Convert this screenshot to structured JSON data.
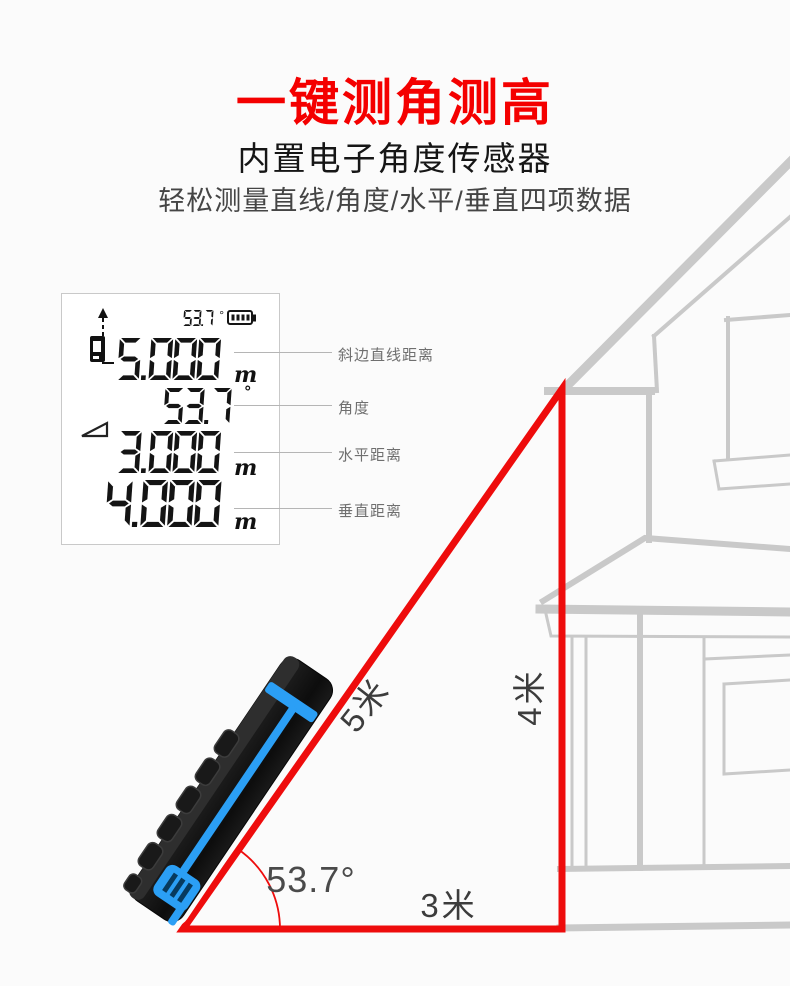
{
  "header": {
    "title": "一键测角测高",
    "subtitle": "内置电子角度传感器",
    "description": "轻松测量直线/角度/水平/垂直四项数据"
  },
  "lcd": {
    "status": {
      "angle_value": "53.7",
      "angle_unit": "°",
      "battery_icon": "battery-full-icon"
    },
    "icons": {
      "reference_icon": "device-rear-reference-icon",
      "slope_icon": "angle-slope-icon"
    },
    "rows": [
      {
        "value": "5.000",
        "unit": "m",
        "label": "斜边直线距离"
      },
      {
        "value": "53.7",
        "unit": "°",
        "label": "角度"
      },
      {
        "value": "3.000",
        "unit": "m",
        "label": "水平距离"
      },
      {
        "value": "4.000",
        "unit": "m",
        "label": "垂直距离"
      }
    ]
  },
  "diagram": {
    "hypotenuse_label": "5米",
    "vertical_label": "4米",
    "horizontal_label": "3米",
    "angle_label": "53.7°"
  },
  "colors": {
    "accent_red": "#f40000",
    "triangle_red": "#ee0c0c",
    "device_blue": "#2b9ff5",
    "house_line": "#c9c9c9",
    "lcd_ink": "#141414"
  }
}
